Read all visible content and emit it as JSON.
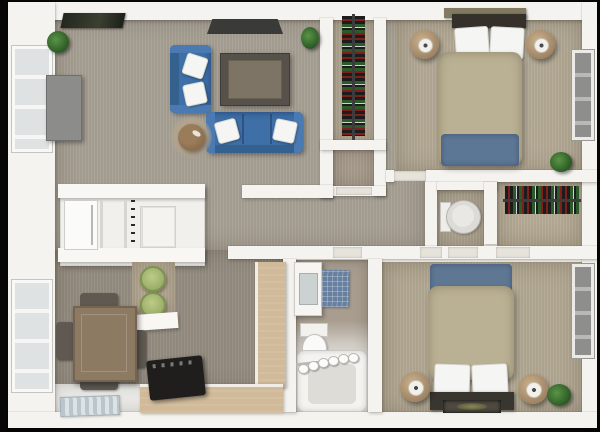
{
  "scene": {
    "kind": "3d-floor-plan-top-down-render",
    "description": "Top-down 3D rendering of a two-bedroom apartment floor plan on a black background"
  },
  "palette": {
    "background": "#070707",
    "wall": "#f4f3ef",
    "wall_shadow": "#d8d6d1",
    "carpet_living": "#a7a094",
    "carpet_dining": "#948c80",
    "carpet_bedroom": "#b3a995",
    "carpet_closet": "#b6ac98",
    "tile_white": "#e8e7e3",
    "sofa_blue": "#3e6fa7",
    "bed_tan": "#bab093",
    "throw_blue": "#5c7795",
    "table_wood": "#8d7a63",
    "counter_wood": "#d0ba99",
    "stool_green": "#a9bd72",
    "stove_black": "#201e1c",
    "bath_mat_blue": "#68809f",
    "plant_green": "#3f7a36",
    "nightstand_wood": "#b0987a",
    "tv_gray": "#8c8c8a",
    "headboard_dark": "#35302a"
  },
  "rooms": [
    {
      "id": "living-room",
      "label": "Living room"
    },
    {
      "id": "kitchen",
      "label": "Kitchen"
    },
    {
      "id": "dining-area",
      "label": "Dining area"
    },
    {
      "id": "hallway",
      "label": "Hallway"
    },
    {
      "id": "bathroom",
      "label": "Bathroom"
    },
    {
      "id": "water-closet",
      "label": "Toilet room"
    },
    {
      "id": "walk-in-closet",
      "label": "Walk-in closet"
    },
    {
      "id": "hall-closet",
      "label": "Hall closet"
    },
    {
      "id": "bedroom-1",
      "label": "Bedroom 1"
    },
    {
      "id": "bedroom-2",
      "label": "Bedroom 2"
    }
  ],
  "furniture": {
    "living_room": [
      "blue-loveseat",
      "blue-sofa",
      "coffee-table",
      "round-ottoman",
      "media-panel",
      "wall-tv",
      "wall-art",
      "potted-plant",
      "potted-plant"
    ],
    "kitchen": [
      "refrigerator",
      "range-knob-strip",
      "cabinets",
      "counter-slab",
      "breakfast-bar",
      "bar-stool",
      "bar-stool"
    ],
    "dining_area": [
      "dining-table",
      "dining-chair",
      "dining-chair",
      "dining-chair",
      "dining-chair",
      "l-shaped-counter",
      "black-range-stove",
      "striped-rug"
    ],
    "bathroom": [
      "vanity-sink",
      "mirror",
      "blue-bath-mat",
      "toilet",
      "bathtub",
      "shower-curtain-rings"
    ],
    "water_closet": [
      "round-toilet"
    ],
    "walk_in_closet": [
      "clothes-rod-with-clothes"
    ],
    "hall_closet": [
      "clothes-rod-with-clothes"
    ],
    "bedroom_1": [
      "double-bed",
      "pillow",
      "pillow",
      "blue-throw-blanket",
      "headboard-shelf",
      "nightstand-with-lamp",
      "nightstand-with-lamp",
      "window",
      "potted-plant"
    ],
    "bedroom_2": [
      "double-bed",
      "pillow",
      "pillow",
      "blue-throw-blanket",
      "bedside-bench",
      "accent-rug",
      "nightstand-with-lamp",
      "nightstand-with-lamp",
      "window",
      "potted-plant"
    ]
  },
  "windows": {
    "left_wall": 2,
    "right_wall": 2
  }
}
